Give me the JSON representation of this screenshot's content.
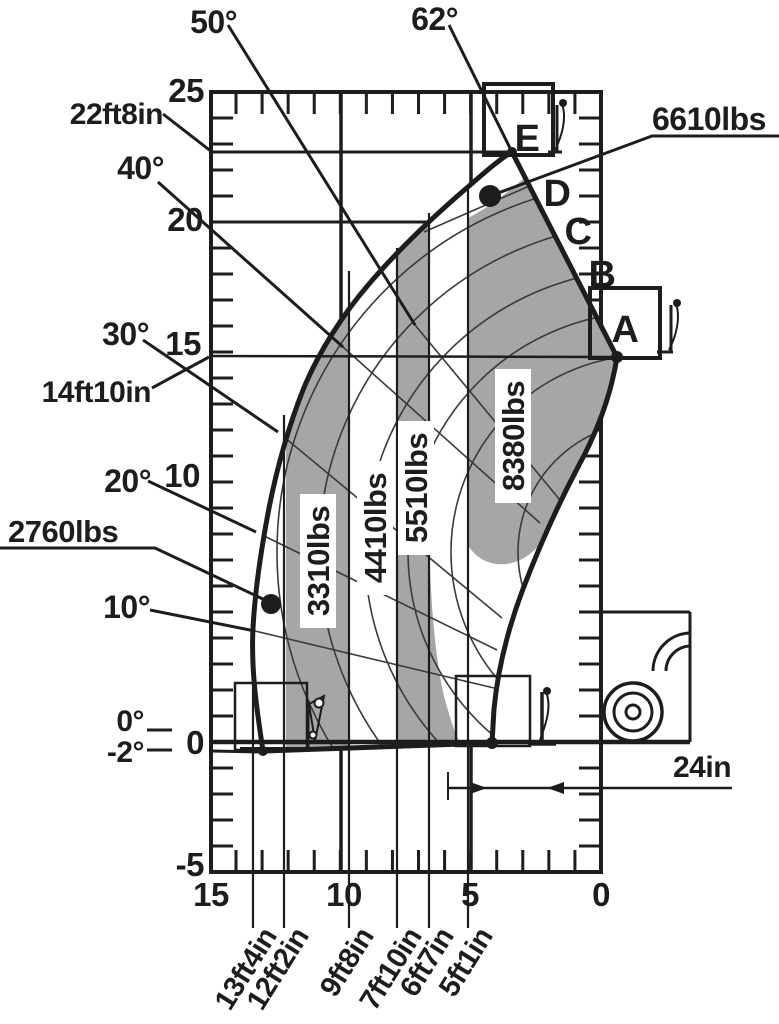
{
  "colors": {
    "ink": "#1d1d1b",
    "zone_gray": "#a6a6a8",
    "bg": "#ffffff"
  },
  "chart": {
    "y_ticks": [
      "25",
      "20",
      "15",
      "10",
      "0",
      "-5"
    ],
    "x_ticks": [
      "15",
      "10",
      "5",
      "0"
    ],
    "angle_labels": {
      "a50": "50°",
      "a62": "62°",
      "a40": "40°",
      "a30": "30°",
      "a20": "20°",
      "a10": "10°",
      "a0": "0°",
      "am2": "-2°"
    },
    "height_labels": {
      "h22": "22ft8in",
      "h14": "14ft10in"
    },
    "point_labels": {
      "p6610": "6610lbs",
      "p2760": "2760lbs"
    },
    "zone_capacities": {
      "z3310": "3310lbs",
      "z4410": "4410lbs",
      "z5510": "5510lbs",
      "z8380": "8380lbs"
    },
    "zone_letters": {
      "A": "A",
      "B": "B",
      "C": "C",
      "D": "D",
      "E": "E"
    },
    "reach_labels": {
      "r253": "13ft4in",
      "r284": "12ft2in",
      "r349": "9ft8in",
      "r397": "7ft10in",
      "r429": "6ft7in",
      "r468": "5ft1in"
    },
    "load_center": "24in"
  },
  "chart_data": {
    "type": "area",
    "title": "Telehandler load capacity chart",
    "x_axis": {
      "label": "forward reach (ft)",
      "range": [
        0,
        15
      ],
      "ticks": [
        15,
        10,
        5,
        0
      ],
      "direction": "reversed",
      "minor_tick_ft": 1
    },
    "y_axis": {
      "label": "lift height (ft)",
      "range": [
        -5,
        25
      ],
      "ticks": [
        25,
        20,
        15,
        10,
        0,
        -5
      ],
      "minor_tick_ft": 1
    },
    "grid": "on",
    "boom_angle_lines_deg": [
      -2,
      0,
      10,
      20,
      30,
      40,
      50,
      62
    ],
    "boom_sections": [
      "A",
      "B",
      "C",
      "D",
      "E"
    ],
    "capacity_zones": [
      {
        "section": "A",
        "capacity_lbs": 8380
      },
      {
        "section": "B",
        "capacity_lbs": 5510
      },
      {
        "section": "C",
        "capacity_lbs": 4410
      },
      {
        "section": "D",
        "capacity_lbs": 3310
      },
      {
        "section": "E",
        "capacity_lbs": 2760
      }
    ],
    "spot_capacity_points": [
      {
        "capacity_lbs": 6610,
        "approx_reach_ft": 4.3,
        "approx_height_ft": 21.0
      },
      {
        "capacity_lbs": 2760,
        "approx_reach_ft": 12.7,
        "approx_height_ft": 5.3
      }
    ],
    "height_references": [
      {
        "label": "22ft8in",
        "height_ft": 22.67,
        "meaning": "max lift height at 62°"
      },
      {
        "label": "14ft10in",
        "height_ft": 14.83,
        "meaning": "height at envelope tip (section A)"
      }
    ],
    "max_reach_dimensions": [
      {
        "label": "13ft4in",
        "reach_ft": 13.33
      },
      {
        "label": "12ft2in",
        "reach_ft": 12.17
      },
      {
        "label": "9ft8in",
        "reach_ft": 9.67
      },
      {
        "label": "7ft10in",
        "reach_ft": 7.83
      },
      {
        "label": "6ft7in",
        "reach_ft": 6.58
      },
      {
        "label": "5ft1in",
        "reach_ft": 5.08
      }
    ],
    "load_center": {
      "label": "24in",
      "inches": 24
    },
    "legend_position": "none"
  }
}
